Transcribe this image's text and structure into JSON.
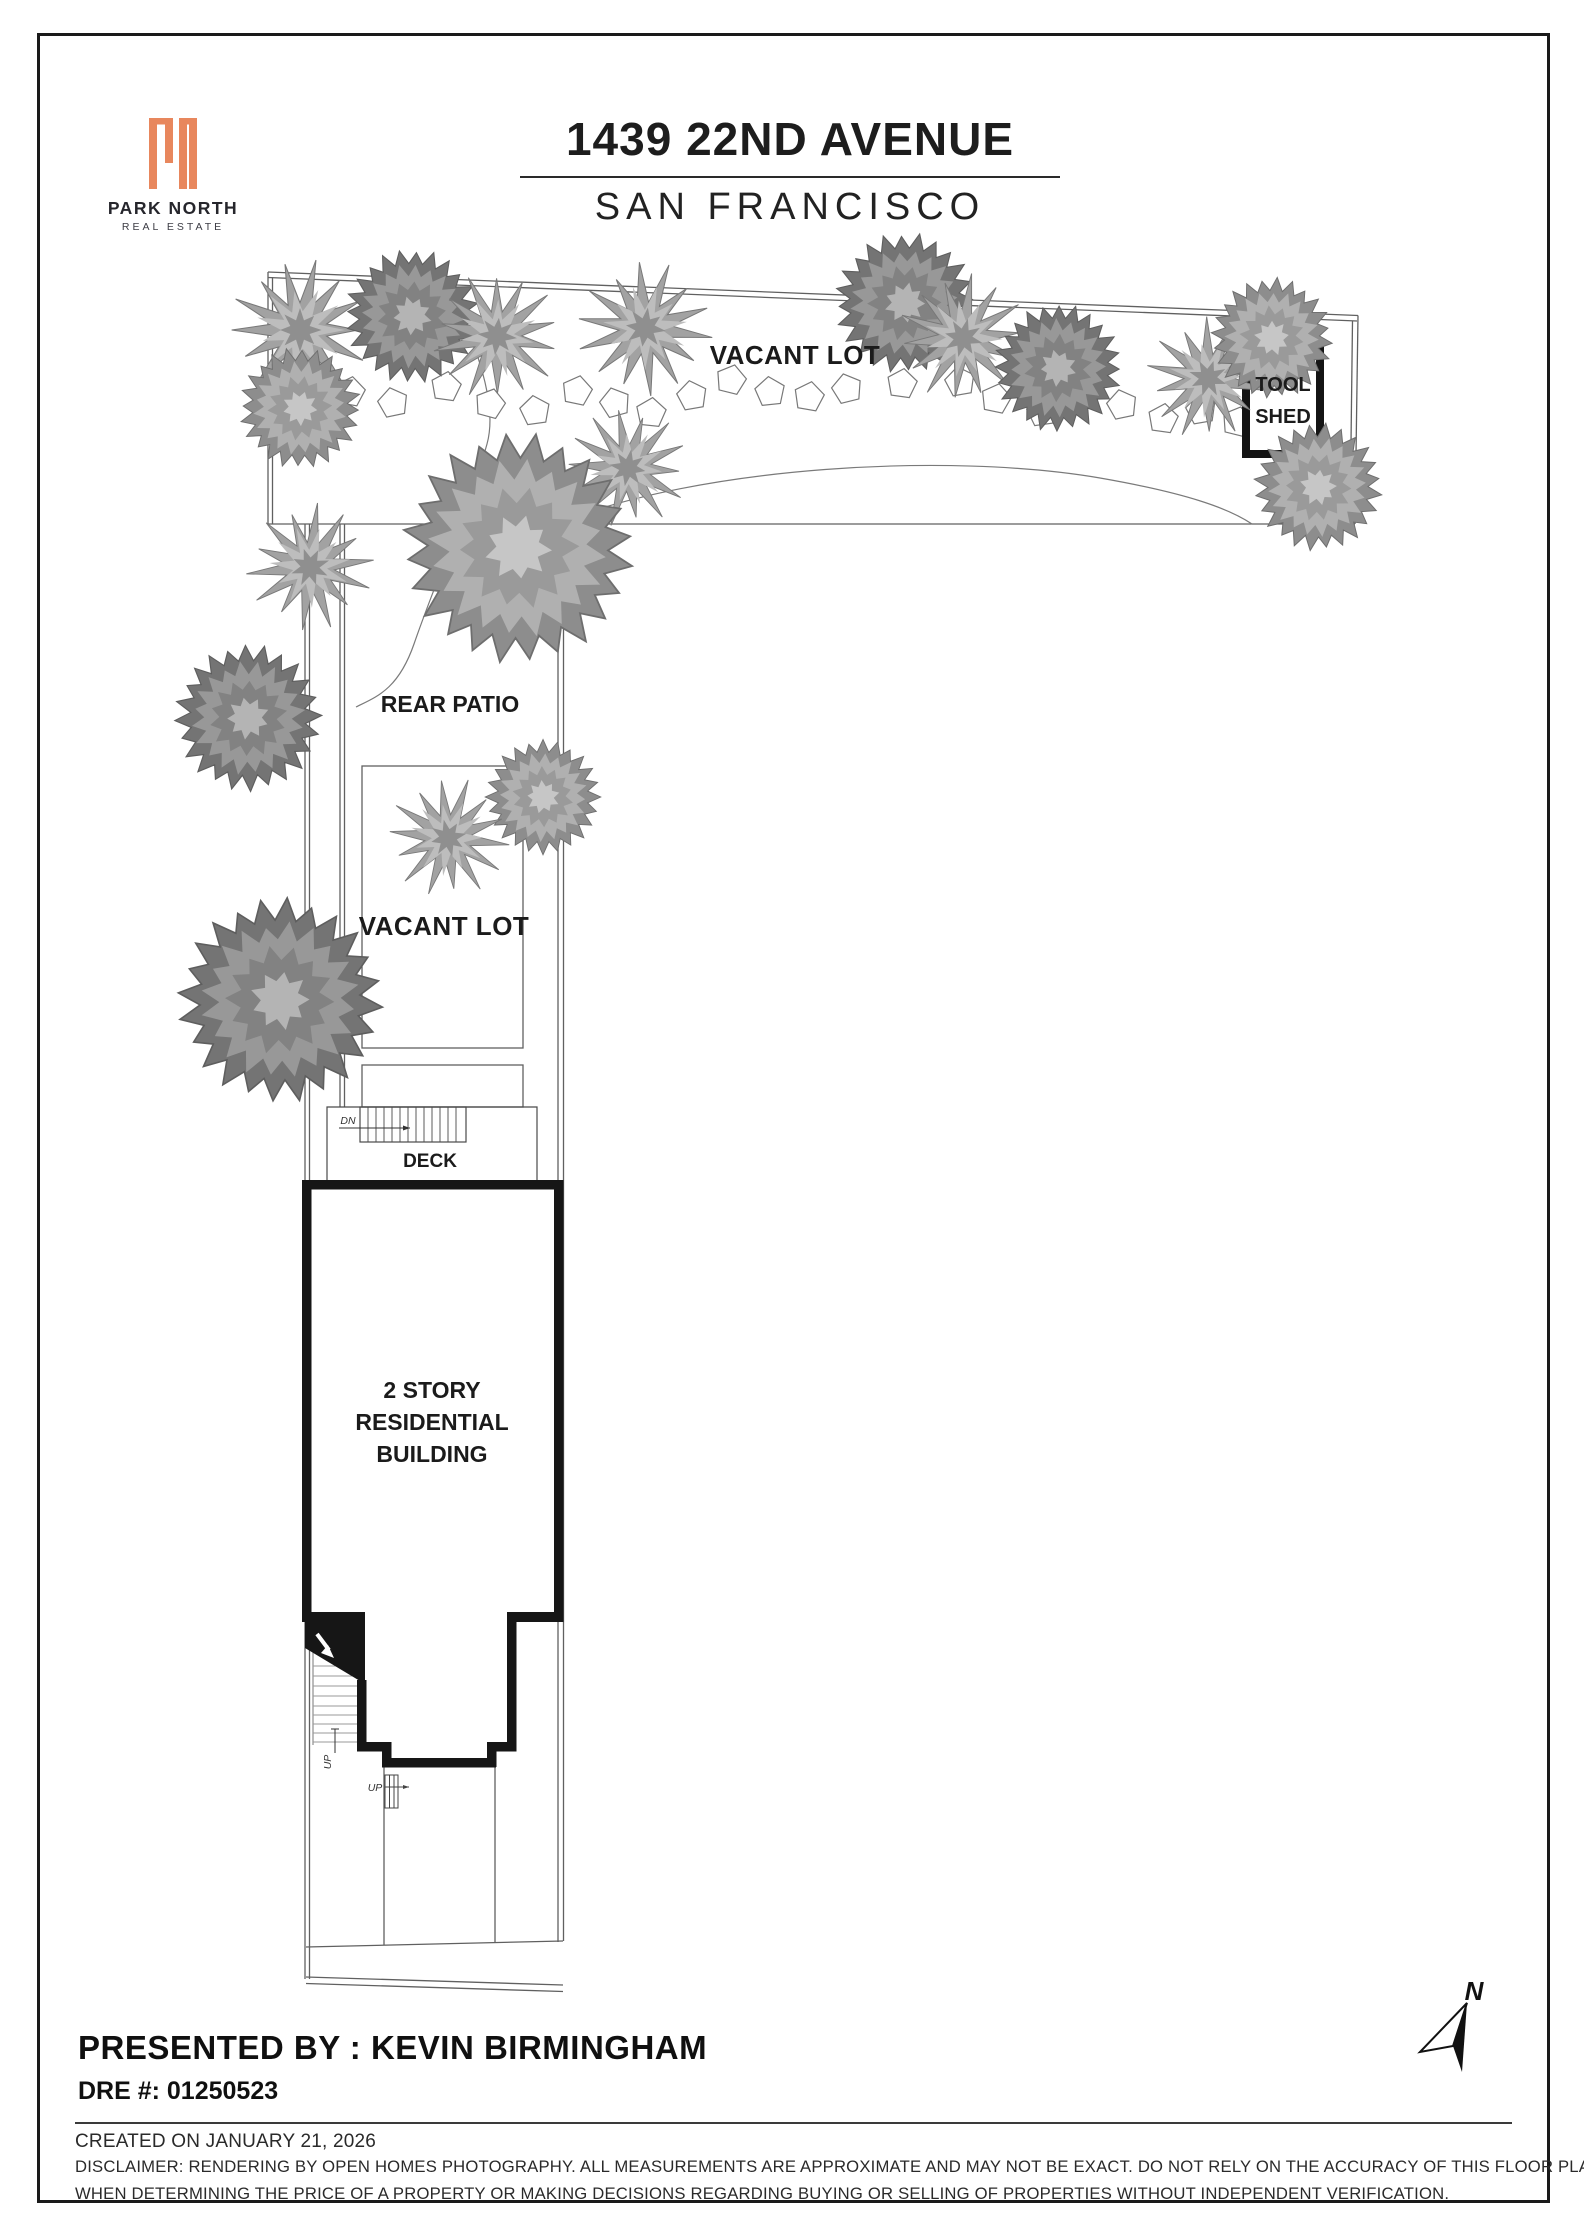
{
  "header": {
    "brand": {
      "name": "PARK NORTH",
      "tagline": "REAL ESTATE",
      "mark": "Pn"
    },
    "title": "1439 22ND AVENUE",
    "subtitle": "SAN FRANCISCO"
  },
  "plan": {
    "labels": {
      "vacant_lot_top": "VACANT LOT",
      "tool_shed_line1": "TOOL",
      "tool_shed_line2": "SHED",
      "rear_patio": "REAR PATIO",
      "vacant_lot_left": "VACANT LOT",
      "deck": "DECK",
      "dn": "DN",
      "up_side": "UP",
      "up_front": "UP",
      "building_line1": "2 STORY",
      "building_line2": "RESIDENTIAL",
      "building_line3": "BUILDING",
      "north": "N"
    },
    "trees": [
      {
        "t": "spiky",
        "x": 300,
        "y": 330,
        "s": 1.05
      },
      {
        "t": "round_light",
        "x": 300,
        "y": 408,
        "s": 0.95
      },
      {
        "t": "round_dark",
        "x": 412,
        "y": 316,
        "s": 1.05
      },
      {
        "t": "spiky",
        "x": 497,
        "y": 336,
        "s": 0.95
      },
      {
        "t": "spiky",
        "x": 645,
        "y": 328,
        "s": 1.0
      },
      {
        "t": "spiky",
        "x": 628,
        "y": 468,
        "s": 0.9
      },
      {
        "t": "round_dark",
        "x": 905,
        "y": 303,
        "s": 1.1
      },
      {
        "t": "spiky",
        "x": 963,
        "y": 338,
        "s": 0.95
      },
      {
        "t": "round_dark",
        "x": 1058,
        "y": 368,
        "s": 1.0
      },
      {
        "t": "spiky",
        "x": 1208,
        "y": 378,
        "s": 0.92
      },
      {
        "t": "round_light",
        "x": 1272,
        "y": 338,
        "s": 0.95
      },
      {
        "t": "round_light",
        "x": 1318,
        "y": 487,
        "s": 1.0
      },
      {
        "t": "round_light",
        "x": 518,
        "y": 548,
        "s": 1.8
      },
      {
        "t": "spiky",
        "x": 310,
        "y": 567,
        "s": 0.95
      },
      {
        "t": "round_dark",
        "x": 248,
        "y": 718,
        "s": 1.15
      },
      {
        "t": "round_light",
        "x": 543,
        "y": 797,
        "s": 0.9
      },
      {
        "t": "spiky",
        "x": 448,
        "y": 838,
        "s": 0.9
      },
      {
        "t": "round_dark",
        "x": 280,
        "y": 1000,
        "s": 1.6
      }
    ],
    "stones": [
      {
        "x": 350,
        "y": 392,
        "r": 10
      },
      {
        "x": 393,
        "y": 403,
        "r": -12
      },
      {
        "x": 446,
        "y": 387,
        "r": 8
      },
      {
        "x": 490,
        "y": 404,
        "r": 15
      },
      {
        "x": 535,
        "y": 411,
        "r": -8
      },
      {
        "x": 577,
        "y": 391,
        "r": 12
      },
      {
        "x": 615,
        "y": 403,
        "r": -15
      },
      {
        "x": 651,
        "y": 413,
        "r": 6
      },
      {
        "x": 692,
        "y": 396,
        "r": -10
      },
      {
        "x": 731,
        "y": 380,
        "r": 14
      },
      {
        "x": 770,
        "y": 392,
        "r": -6
      },
      {
        "x": 809,
        "y": 397,
        "r": 10
      },
      {
        "x": 847,
        "y": 389,
        "r": -14
      },
      {
        "x": 902,
        "y": 384,
        "r": 8
      },
      {
        "x": 960,
        "y": 382,
        "r": -10
      },
      {
        "x": 996,
        "y": 399,
        "r": 12
      },
      {
        "x": 1042,
        "y": 412,
        "r": -8
      },
      {
        "x": 1080,
        "y": 394,
        "r": 10
      },
      {
        "x": 1122,
        "y": 405,
        "r": -12
      },
      {
        "x": 1163,
        "y": 419,
        "r": 8
      },
      {
        "x": 1201,
        "y": 410,
        "r": -10
      },
      {
        "x": 1237,
        "y": 422,
        "r": 14
      }
    ]
  },
  "footer": {
    "presented_by": "PRESENTED BY : KEVIN BIRMINGHAM",
    "dre": "DRE #: 01250523",
    "created": "CREATED ON JANUARY 21, 2026",
    "disclaimer_line1": "DISCLAIMER: RENDERING BY OPEN HOMES PHOTOGRAPHY. ALL MEASUREMENTS ARE APPROXIMATE AND MAY NOT BE EXACT. DO NOT RELY ON THE ACCURACY OF THIS FLOOR PLAN",
    "disclaimer_line2": "WHEN DETERMINING THE PRICE OF A PROPERTY OR MAKING DECISIONS REGARDING BUYING OR SELLING OF PROPERTIES WITHOUT INDEPENDENT VERIFICATION."
  },
  "colors": {
    "accent": "#E8875D",
    "ink": "#1b1b1b",
    "line": "#606060"
  }
}
